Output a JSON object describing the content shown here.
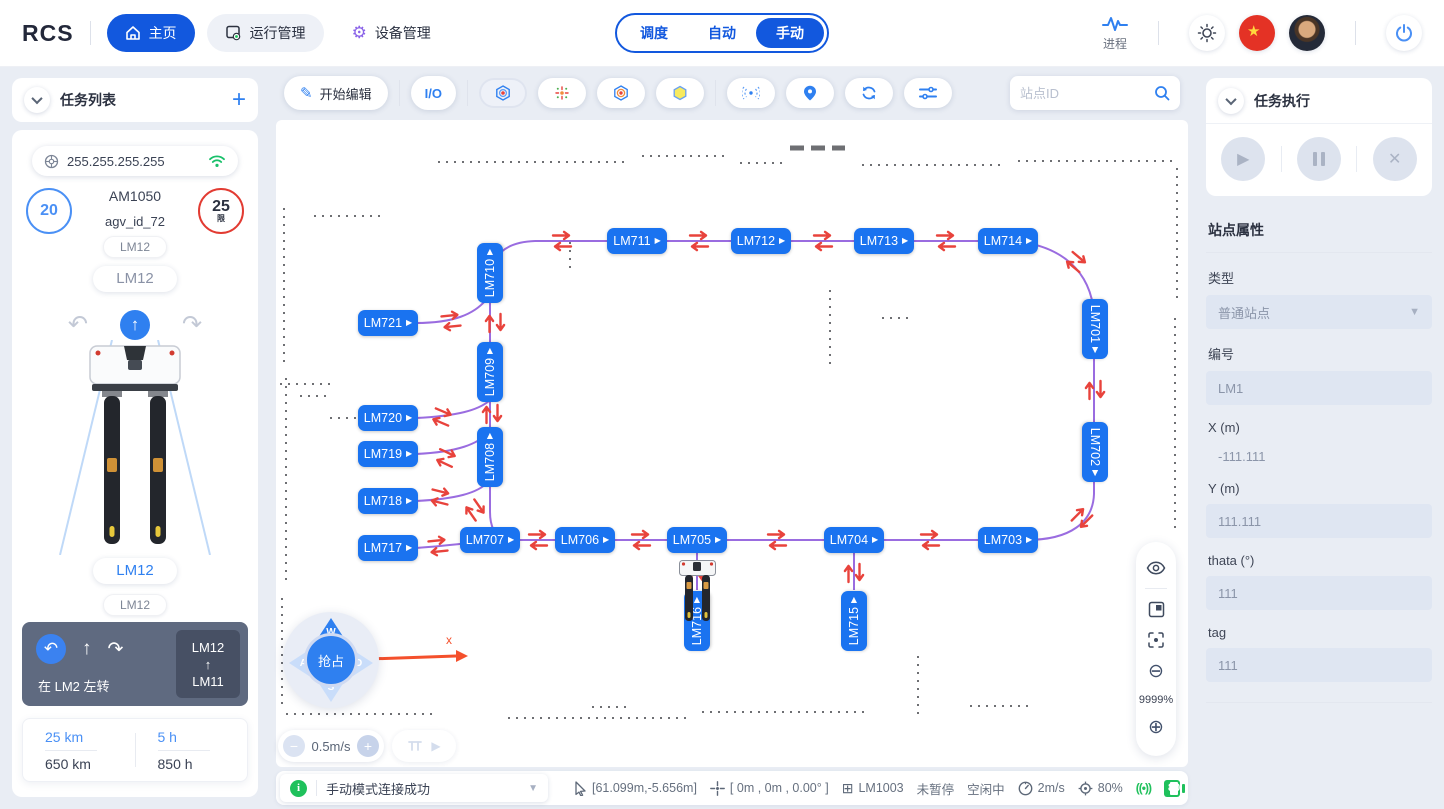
{
  "topbar": {
    "logo": "RCS",
    "nav": [
      {
        "label": "主页"
      },
      {
        "label": "运行管理"
      },
      {
        "label": "设备管理"
      }
    ],
    "tabs": [
      "调度",
      "自动",
      "手动"
    ],
    "active_tab": "手动",
    "process_label": "进程"
  },
  "left": {
    "header": "任务列表",
    "ip": "255.255.255.255",
    "speed": "20",
    "limit": "25",
    "limit_suffix": "限",
    "model": "AM1050",
    "agv_id": "agv_id_72",
    "tag_top": "LM12",
    "tag_mid": "LM12",
    "tag_current": "LM12",
    "tag_next": "LM12",
    "nav_card": {
      "instruction": "在 LM2 左转",
      "from": "LM12",
      "to": "LM11",
      "up_glyph": "↑",
      "back_glyph": "↶",
      "fwd_glyph": "↷"
    },
    "stats": [
      {
        "top": "25 km",
        "bottom": "650 km"
      },
      {
        "top": "5 h",
        "bottom": "850 h"
      }
    ]
  },
  "toolbar": {
    "edit_label": "开始编辑",
    "io_label": "I/O",
    "search_placeholder": "站点ID"
  },
  "map": {
    "zoom_label": "9999%",
    "speed_value": "0.5m/s",
    "axis_label": "x",
    "joystick": {
      "center": "抢占",
      "up": "W",
      "left": "A",
      "right": "D",
      "down": "S"
    },
    "badge_arrow": "▶",
    "stations": [
      {
        "id": "LM711",
        "x": 367,
        "y": 175,
        "rot": 0
      },
      {
        "id": "LM712",
        "x": 491,
        "y": 175,
        "rot": 0
      },
      {
        "id": "LM713",
        "x": 614,
        "y": 175,
        "rot": 0
      },
      {
        "id": "LM714",
        "x": 738,
        "y": 175,
        "rot": 0
      },
      {
        "id": "LM710",
        "x": 220,
        "y": 207,
        "rot": -90
      },
      {
        "id": "LM721",
        "x": 118,
        "y": 257,
        "rot": 0
      },
      {
        "id": "LM709",
        "x": 220,
        "y": 306,
        "rot": -90
      },
      {
        "id": "LM720",
        "x": 118,
        "y": 352,
        "rot": 0
      },
      {
        "id": "LM719",
        "x": 118,
        "y": 388,
        "rot": 0
      },
      {
        "id": "LM708",
        "x": 220,
        "y": 391,
        "rot": -90
      },
      {
        "id": "LM718",
        "x": 118,
        "y": 435,
        "rot": 0
      },
      {
        "id": "LM717",
        "x": 118,
        "y": 482,
        "rot": 0
      },
      {
        "id": "LM707",
        "x": 220,
        "y": 474,
        "rot": 0
      },
      {
        "id": "LM706",
        "x": 315,
        "y": 474,
        "rot": 0
      },
      {
        "id": "LM705",
        "x": 427,
        "y": 474,
        "rot": 0
      },
      {
        "id": "LM704",
        "x": 584,
        "y": 474,
        "rot": 0
      },
      {
        "id": "LM703",
        "x": 738,
        "y": 474,
        "rot": 0
      },
      {
        "id": "LM701",
        "x": 825,
        "y": 263,
        "rot": 90
      },
      {
        "id": "LM702",
        "x": 825,
        "y": 386,
        "rot": 90
      },
      {
        "id": "LM716",
        "x": 427,
        "y": 555,
        "rot": -90
      },
      {
        "id": "LM715",
        "x": 584,
        "y": 555,
        "rot": -90
      }
    ],
    "arrow_pairs": [
      {
        "x": 292,
        "y": 175,
        "rot": 0
      },
      {
        "x": 429,
        "y": 175,
        "rot": 0
      },
      {
        "x": 553,
        "y": 175,
        "rot": 0
      },
      {
        "x": 676,
        "y": 175,
        "rot": 0
      },
      {
        "x": 806,
        "y": 196,
        "rot": 40
      },
      {
        "x": 825,
        "y": 324,
        "rot": 90
      },
      {
        "x": 812,
        "y": 452,
        "rot": 135
      },
      {
        "x": 660,
        "y": 474,
        "rot": 0
      },
      {
        "x": 507,
        "y": 474,
        "rot": 0
      },
      {
        "x": 371,
        "y": 474,
        "rot": 0
      },
      {
        "x": 268,
        "y": 474,
        "rot": 0
      },
      {
        "x": 168,
        "y": 480,
        "rot": -6
      },
      {
        "x": 205,
        "y": 444,
        "rot": 55
      },
      {
        "x": 225,
        "y": 257,
        "rot": 90
      },
      {
        "x": 181,
        "y": 255,
        "rot": -6
      },
      {
        "x": 222,
        "y": 348,
        "rot": 90
      },
      {
        "x": 172,
        "y": 351,
        "rot": 23
      },
      {
        "x": 176,
        "y": 392,
        "rot": 25
      },
      {
        "x": 170,
        "y": 431,
        "rot": 14
      },
      {
        "x": 427,
        "y": 507,
        "rot": 90
      },
      {
        "x": 584,
        "y": 507,
        "rot": 90
      }
    ]
  },
  "right": {
    "exec_header": "任务执行",
    "props_title": "站点属性",
    "fields": [
      {
        "label": "类型",
        "value": "普通站点"
      },
      {
        "label": "编号",
        "value": "LM1"
      },
      {
        "label": "X (m)",
        "value": "-111.111"
      },
      {
        "label": "Y (m)",
        "value": "111.111"
      },
      {
        "label": "thata (°)",
        "value": "111"
      },
      {
        "label": "tag",
        "value": "111"
      }
    ]
  },
  "statusbar": {
    "message": "手动模式连接成功",
    "pointer_coords": "[61.099m,-5.656m]",
    "robot_pose": "[ 0m , 0m , 0.00° ]",
    "station": "LM1003",
    "pause_state": "未暂停",
    "task_state": "空闲中",
    "speed": "2m/s",
    "reliability": "80%",
    "signal_glyph": "((•))",
    "battery": "80"
  }
}
